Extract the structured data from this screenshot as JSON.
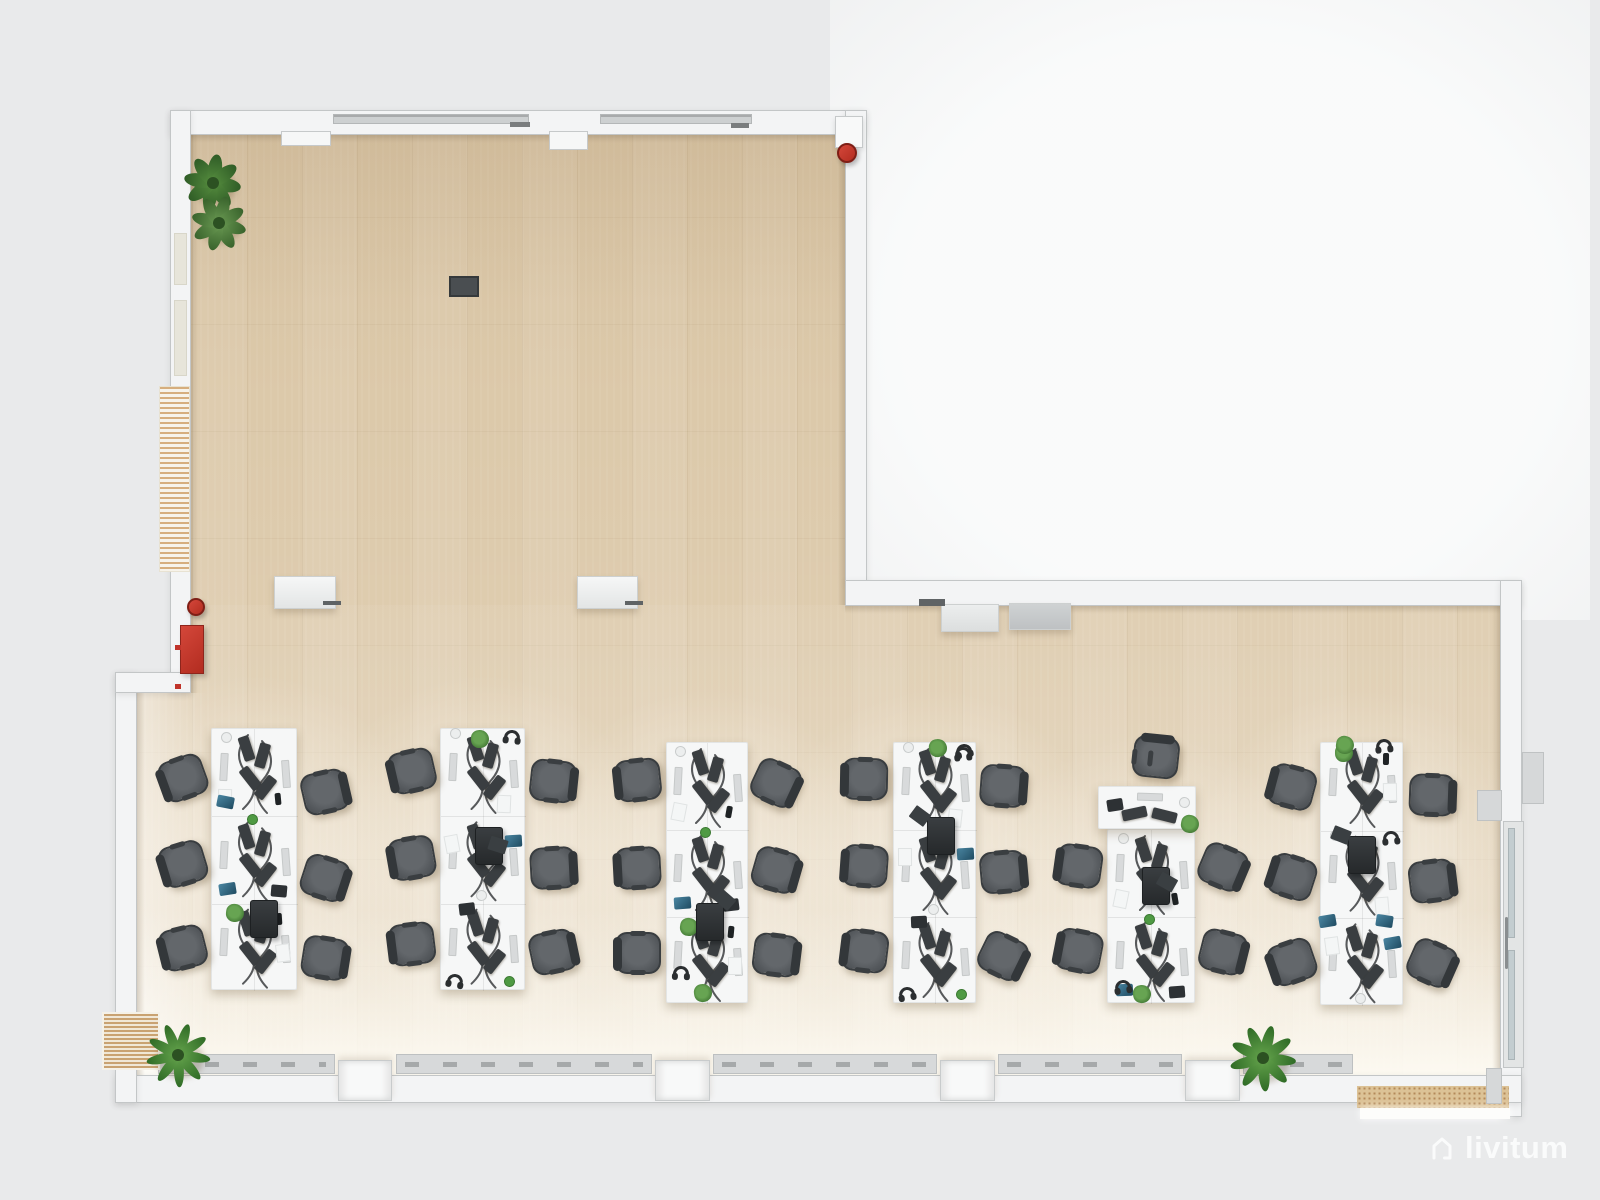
{
  "watermark": {
    "text": "livitum",
    "icon": "house-icon"
  },
  "colors": {
    "background": "#e9eaeb",
    "ambient_glow": "#fafbfb",
    "floor_wood": "#dcc9aa",
    "wall": "#f3f4f5",
    "desk": "#f6f7f7",
    "chair": "#54585c",
    "monitor": "#3a3e41",
    "plant_green": "#4f8a3c",
    "safety_red": "#c0332a",
    "radiator_gray": "#d7d9da",
    "mat_tan": "#d9bc8e",
    "watermark_white": "#fafbfb"
  },
  "floorplan": {
    "walls": [
      {
        "x": 170,
        "y": 110,
        "w": 696,
        "h": 25
      },
      {
        "x": 170,
        "y": 110,
        "w": 21,
        "h": 582
      },
      {
        "x": 845,
        "y": 110,
        "w": 22,
        "h": 473
      },
      {
        "x": 845,
        "y": 580,
        "w": 677,
        "h": 26
      },
      {
        "x": 1500,
        "y": 580,
        "w": 22,
        "h": 537
      },
      {
        "x": 115,
        "y": 1075,
        "w": 1407,
        "h": 28
      },
      {
        "x": 115,
        "y": 672,
        "w": 22,
        "h": 431
      },
      {
        "x": 115,
        "y": 672,
        "w": 76,
        "h": 21
      }
    ],
    "wall_notches": [
      {
        "x": 281,
        "y": 131,
        "w": 50,
        "h": 15
      },
      {
        "x": 549,
        "y": 131,
        "w": 39,
        "h": 19
      }
    ],
    "ceiling_vents": [
      {
        "x": 333,
        "y": 114,
        "w": 196,
        "h": 10
      },
      {
        "x": 600,
        "y": 114,
        "w": 152,
        "h": 10
      }
    ],
    "vent_dashes": [
      {
        "x": 510,
        "y": 122,
        "w": 20,
        "h": 5
      },
      {
        "x": 731,
        "y": 123,
        "w": 18,
        "h": 5
      }
    ],
    "window_panes_left": [
      {
        "x": 174,
        "y": 233,
        "w": 13,
        "h": 52
      },
      {
        "x": 174,
        "y": 300,
        "w": 13,
        "h": 76
      }
    ],
    "wall_hatch_left": {
      "x": 159,
      "y": 386,
      "w": 31,
      "h": 186
    },
    "bottom_pillars": [
      {
        "x": 338,
        "y": 1060,
        "w": 54,
        "h": 41
      },
      {
        "x": 655,
        "y": 1060,
        "w": 55,
        "h": 41
      },
      {
        "x": 940,
        "y": 1060,
        "w": 55,
        "h": 41
      },
      {
        "x": 1185,
        "y": 1060,
        "w": 55,
        "h": 41
      }
    ],
    "radiators": [
      {
        "x": 158,
        "y": 1054,
        "w": 177,
        "h": 20
      },
      {
        "x": 396,
        "y": 1054,
        "w": 256,
        "h": 20
      },
      {
        "x": 713,
        "y": 1054,
        "w": 224,
        "h": 20
      },
      {
        "x": 998,
        "y": 1054,
        "w": 184,
        "h": 20
      },
      {
        "x": 1243,
        "y": 1054,
        "w": 110,
        "h": 20
      }
    ],
    "entrance_mats": [
      {
        "x": 102,
        "y": 1012,
        "w": 58,
        "h": 58,
        "style": "stripes"
      },
      {
        "x": 1357,
        "y": 1086,
        "w": 152,
        "h": 22,
        "style": "dots"
      }
    ],
    "door_sill": {
      "x": 1360,
      "y": 1108,
      "w": 150,
      "h": 11
    },
    "wall_stubs": [
      {
        "x": 1477,
        "y": 790,
        "w": 25,
        "h": 31
      },
      {
        "x": 1486,
        "y": 1068,
        "w": 16,
        "h": 36
      },
      {
        "x": 1522,
        "y": 752,
        "w": 22,
        "h": 52
      }
    ],
    "glass_door_right": {
      "x": 1503,
      "y": 821,
      "w": 21,
      "h": 247
    },
    "floor_socket": {
      "x": 449,
      "y": 276,
      "w": 30,
      "h": 21
    },
    "edge_shades": [
      {
        "x": 53,
        "y": 23,
        "w": 655,
        "h": 9,
        "dir": "down"
      },
      {
        "x": 53,
        "y": 23,
        "w": 8,
        "h": 560,
        "dir": "right"
      },
      {
        "x": 708,
        "y": 495,
        "w": 655,
        "h": 8,
        "dir": "down"
      },
      {
        "x": 0,
        "y": 583,
        "w": 8,
        "h": 382,
        "dir": "right"
      },
      {
        "x": 700,
        "y": 23,
        "w": 8,
        "h": 472,
        "dir": "left"
      },
      {
        "x": 1355,
        "y": 495,
        "w": 8,
        "h": 470,
        "dir": "left"
      }
    ],
    "washes": [
      {
        "x": 0,
        "y": 495,
        "w": 1363,
        "h": 470,
        "css": "linear-gradient(180deg, rgba(255,255,255,.05), rgba(255,255,255,.25))"
      },
      {
        "x": 0,
        "y": 800,
        "w": 1363,
        "h": 165,
        "css": "linear-gradient(180deg, rgba(255,253,246,0), rgba(255,253,246,.85))"
      },
      {
        "x": 0,
        "y": 583,
        "w": 70,
        "h": 382,
        "css": "linear-gradient(90deg, rgba(255,255,255,.5), rgba(255,255,255,0))"
      },
      {
        "x": 53,
        "y": 23,
        "w": 655,
        "h": 170,
        "css": "linear-gradient(180deg, rgba(150,120,80,.10), rgba(150,120,80,0))"
      }
    ]
  },
  "fixtures": {
    "sideboards": [
      {
        "x": 274,
        "y": 576,
        "w": 62,
        "h": 33,
        "tone": "light"
      },
      {
        "x": 577,
        "y": 576,
        "w": 61,
        "h": 33,
        "tone": "light"
      },
      {
        "x": 941,
        "y": 604,
        "w": 58,
        "h": 28,
        "tone": "mid"
      },
      {
        "x": 1009,
        "y": 603,
        "w": 62,
        "h": 27,
        "tone": "dark"
      }
    ],
    "dark_marks": [
      {
        "x": 919,
        "y": 599,
        "w": 26,
        "h": 7
      },
      {
        "x": 323,
        "y": 601,
        "w": 18,
        "h": 4
      },
      {
        "x": 625,
        "y": 601,
        "w": 18,
        "h": 4
      }
    ],
    "extinguisher_shelf": {
      "bracket": {
        "x": 835,
        "y": 116,
        "w": 28,
        "h": 32
      },
      "cx": 847,
      "cy": 153,
      "r": 10
    },
    "extinguisher_floor": {
      "cx": 196,
      "cy": 607,
      "r": 9
    },
    "hose_cabinet": {
      "x": 180,
      "y": 625,
      "w": 24,
      "h": 49
    },
    "red_wall_marks": [
      {
        "x": 175,
        "y": 645,
        "w": 6,
        "h": 5
      },
      {
        "x": 175,
        "y": 684,
        "w": 6,
        "h": 5
      }
    ],
    "plants": [
      {
        "cx": 213,
        "cy": 183,
        "r": 27,
        "kind": "leafy"
      },
      {
        "cx": 219,
        "cy": 223,
        "r": 26,
        "kind": "vari"
      },
      {
        "cx": 178,
        "cy": 1055,
        "r": 30,
        "kind": "palm"
      },
      {
        "cx": 1263,
        "cy": 1058,
        "r": 31,
        "kind": "palm"
      }
    ]
  },
  "furniture": {
    "module_template": {
      "monitors": [
        {
          "fx": 0.4,
          "fy": 0.22,
          "rot": -18
        },
        {
          "fx": 0.44,
          "fy": 0.56,
          "rot": -38
        },
        {
          "fx": 0.58,
          "fy": 0.3,
          "rot": 16
        },
        {
          "fx": 0.62,
          "fy": 0.66,
          "rot": 38
        }
      ],
      "keyboards": [
        {
          "fx": 0.14,
          "fy": 0.44,
          "rot": 3
        },
        {
          "fx": 0.86,
          "fy": 0.52,
          "rot": -4
        }
      ]
    },
    "prop_patterns": [
      [
        [
          "cup",
          0.2,
          0.13
        ],
        [
          "paper",
          0.16,
          0.78
        ],
        [
          "phone",
          0.82,
          0.82
        ]
      ],
      [
        [
          "laptopBlue",
          0.18,
          0.86
        ],
        [
          "cupGreen",
          0.5,
          0.06
        ],
        [
          "laptopDark",
          0.78,
          0.88
        ]
      ],
      [
        [
          "plantSmall",
          0.26,
          0.1
        ],
        [
          "phone",
          0.84,
          0.2
        ],
        [
          "paper",
          0.84,
          0.55
        ]
      ],
      [
        [
          "headphones",
          0.84,
          0.1
        ],
        [
          "cup",
          0.2,
          0.08
        ],
        [
          "paper",
          0.75,
          0.85
        ]
      ],
      [
        [
          "cup",
          0.5,
          0.94
        ],
        [
          "laptopBlue",
          0.85,
          0.3
        ],
        [
          "paper",
          0.14,
          0.3
        ]
      ],
      [
        [
          "headphones",
          0.16,
          0.9
        ],
        [
          "cupGreen",
          0.84,
          0.92
        ],
        [
          "laptopDark",
          0.3,
          0.08
        ]
      ]
    ],
    "clusters": [
      {
        "id": "c1",
        "x": 211,
        "y": 728,
        "w": 86,
        "h": 262,
        "modules": 3,
        "chairs_left": {
          "cx": 183,
          "ys": [
            778,
            864,
            948
          ]
        },
        "chairs_right": {
          "cx": 325,
          "ys": [
            792,
            878,
            958
          ]
        },
        "extras": [
          [
            "printer",
            0.56,
            0.7
          ],
          [
            "laptopBlue",
            0.18,
            0.3
          ]
        ]
      },
      {
        "id": "c2",
        "x": 440,
        "y": 728,
        "w": 85,
        "h": 262,
        "modules": 3,
        "chairs_left": {
          "cx": 412,
          "ys": [
            771,
            858,
            944
          ]
        },
        "chairs_right": {
          "cx": 553,
          "ys": [
            781,
            868,
            952
          ]
        },
        "extras": [
          [
            "plantSmall",
            0.47,
            0.05
          ],
          [
            "printer",
            0.52,
            0.42
          ],
          [
            "paperDark",
            0.68,
            0.46
          ]
        ]
      },
      {
        "id": "c3",
        "x": 666,
        "y": 742,
        "w": 82,
        "h": 261,
        "modules": 3,
        "chairs_left": {
          "cx": 638,
          "ys": [
            780,
            868,
            953
          ]
        },
        "chairs_right": {
          "cx": 776,
          "ys": [
            783,
            870,
            955
          ]
        },
        "extras": [
          [
            "printer",
            0.48,
            0.66
          ],
          [
            "paperDark",
            0.72,
            0.62
          ],
          [
            "plantSmall",
            0.45,
            0.97
          ],
          [
            "headphones",
            0.2,
            0.9
          ]
        ]
      },
      {
        "id": "c4",
        "x": 893,
        "y": 742,
        "w": 83,
        "h": 261,
        "modules": 3,
        "chairs_left": {
          "cx": 865,
          "ys": [
            779,
            866,
            951
          ]
        },
        "chairs_right": {
          "cx": 1003,
          "ys": [
            786,
            872,
            956
          ]
        },
        "extras": [
          [
            "plantSmall",
            0.54,
            0.03
          ],
          [
            "headphones",
            0.86,
            0.06
          ],
          [
            "printer",
            0.52,
            0.33
          ],
          [
            "paperDark",
            0.32,
            0.3
          ]
        ]
      },
      {
        "id": "c5",
        "x": 1107,
        "y": 829,
        "w": 88,
        "h": 174,
        "modules": 2,
        "chairs_left": {
          "cx": 1079,
          "ys": [
            866,
            951
          ]
        },
        "chairs_right": {
          "cx": 1223,
          "ys": [
            867,
            952
          ]
        },
        "top_desk": {
          "x": 1098,
          "y": 786,
          "w": 98,
          "h": 43
        },
        "top_chair": {
          "cx": 1156,
          "cy": 757
        },
        "extras": [
          [
            "printer",
            0.5,
            0.28
          ],
          [
            "paperDark",
            0.68,
            0.33
          ],
          [
            "plantSmall",
            0.4,
            0.96
          ],
          [
            "headphones",
            0.19,
            0.93
          ]
        ]
      },
      {
        "id": "c6",
        "x": 1320,
        "y": 742,
        "w": 83,
        "h": 263,
        "modules": 3,
        "chairs_left": {
          "cx": 1292,
          "ys": [
            787,
            877,
            962
          ]
        },
        "chairs_right": {
          "cx": 1432,
          "ys": [
            795,
            881,
            963
          ]
        },
        "extras": [
          [
            "plantSmall",
            0.3,
            0.02
          ],
          [
            "headphones",
            0.78,
            0.03
          ],
          [
            "printer",
            0.45,
            0.4
          ],
          [
            "paperDark",
            0.25,
            0.37
          ],
          [
            "laptopBlue",
            0.1,
            0.7
          ],
          [
            "laptopBlue",
            0.78,
            0.7
          ]
        ]
      }
    ]
  }
}
